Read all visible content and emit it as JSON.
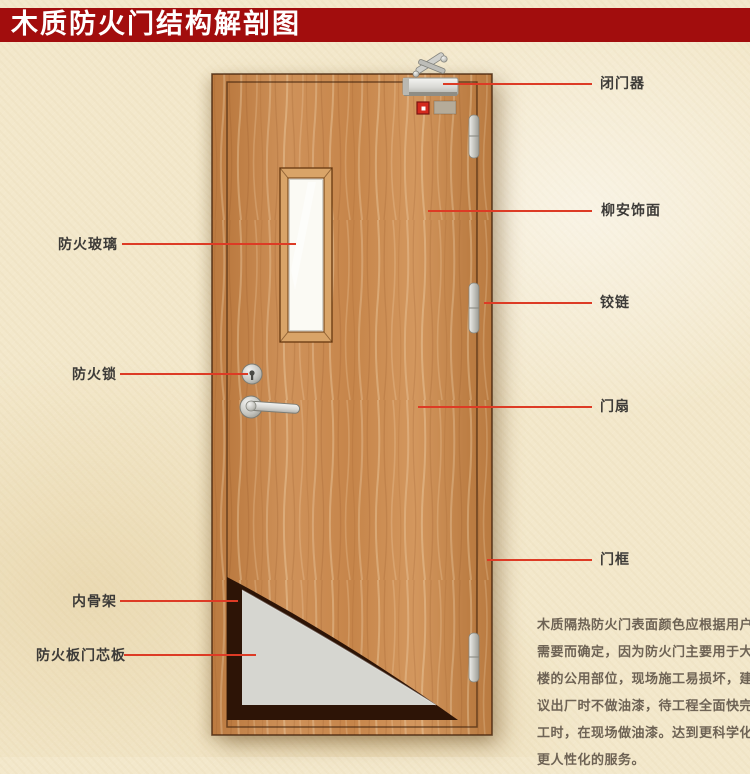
{
  "title": "木质防火门结构解剖图",
  "colors": {
    "banner_red": "#a20d0d",
    "leader_red": "#dd3b25",
    "wood": "#c98a52",
    "core_gray": "#d6d6d0",
    "cutaway_dark": "#2d1406",
    "glass_white": "#fbfaf4",
    "background_cream": "#f3e8cb"
  },
  "annotations": {
    "door_closer": {
      "label": "闭门器"
    },
    "veneer": {
      "label": "柳安饰面"
    },
    "hinge": {
      "label": "铰链"
    },
    "door_leaf": {
      "label": "门扇"
    },
    "door_frame": {
      "label": "门框"
    },
    "fire_glass": {
      "label": "防火玻璃"
    },
    "fire_lock": {
      "label": "防火锁"
    },
    "inner_skeleton": {
      "label": "内骨架"
    },
    "fire_core_board": {
      "label": "防火板门芯板"
    }
  },
  "description": {
    "lines": [
      "木质隔热防火门表面颜色应根据用户",
      "需要而确定，因为防火门主要用于大",
      "楼的公用部位，现场施工易损坏，建",
      "议出厂时不做油漆，待工程全面快完",
      "工时，在现场做油漆。达到更科学化",
      "更人性化的服务。"
    ]
  }
}
